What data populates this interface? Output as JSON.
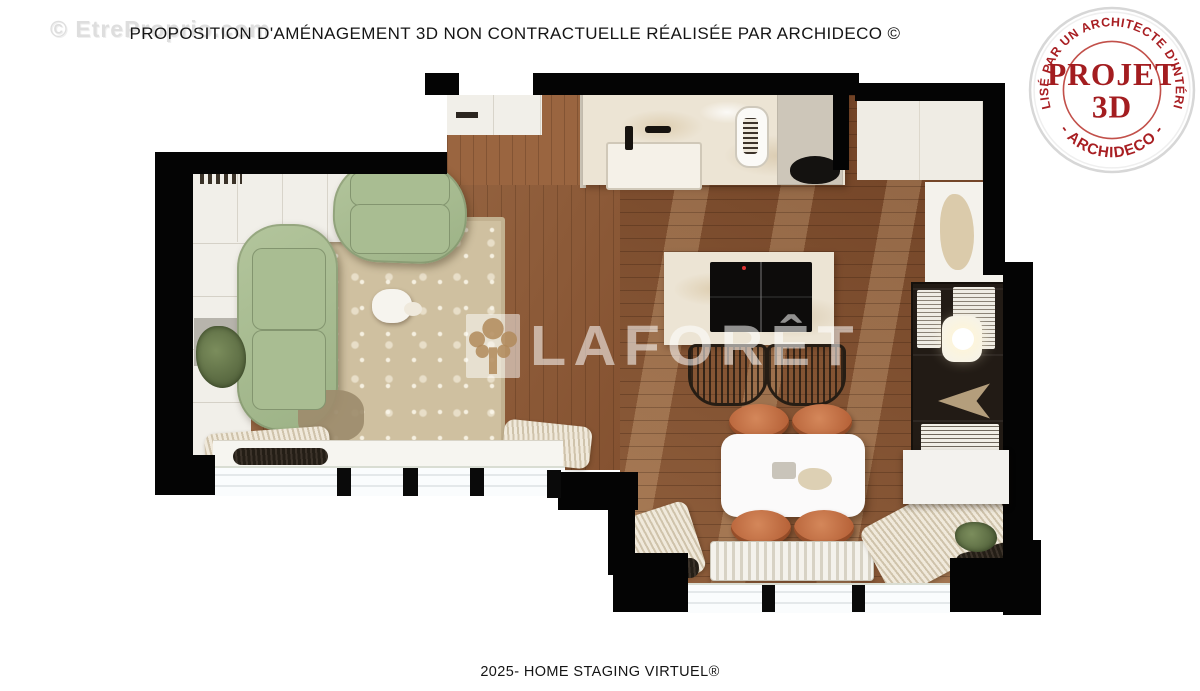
{
  "page": {
    "corner_watermark": "© EtreProprio.com",
    "title": "PROPOSITION D'AMÉNAGEMENT 3D NON CONTRACTUELLE RÉALISÉE PAR ARCHIDECO ©",
    "footer": "2025- HOME STAGING VIRTUEL®"
  },
  "stamp": {
    "arc_text_top": "RÉALISÉ PAR UN ARCHITECTE D'INTÉRIEUR",
    "arc_text_bottom": "- ARCHIDECO -",
    "center_line1": "PROJET",
    "center_line2": "3D",
    "ink_color": "#a81e22"
  },
  "plan_watermark": {
    "brand_text": "LAFORÊT"
  },
  "floorplan": {
    "areas": [
      "living-room",
      "entry",
      "kitchen",
      "kitchen-island",
      "dining-area",
      "shelving-wall"
    ],
    "colors": {
      "wall": "#040404",
      "wood_floor": "#7c4a2b",
      "sofa_green": "#a9bc92",
      "rug_beige": "#cfc0a0",
      "chair_terracotta": "#c0724a",
      "bookshelf_dark": "#221b15",
      "marble_counter": "#ece4d4",
      "textile_cream": "#eee8da"
    }
  }
}
